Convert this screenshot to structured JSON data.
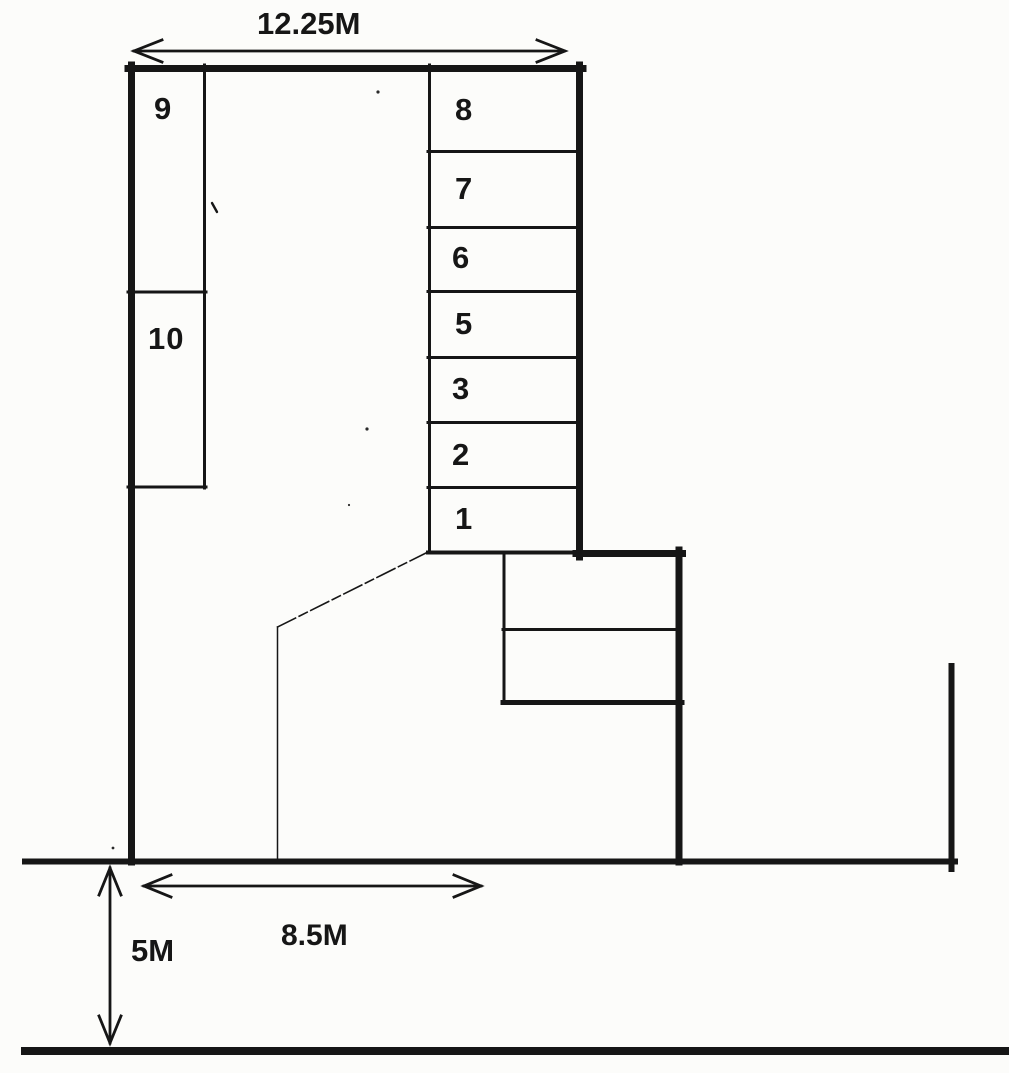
{
  "colors": {
    "ink": "#161616",
    "paper": "#fcfcfa"
  },
  "spaces": {
    "s1": "1",
    "s2": "2",
    "s3": "3",
    "s5": "5",
    "s6": "6",
    "s7": "7",
    "s8": "8",
    "s9": "9",
    "s10": "10"
  },
  "dimensions": {
    "top_width": "12.25M",
    "bottom_frontage": "8.5M",
    "road_width": "5M"
  }
}
